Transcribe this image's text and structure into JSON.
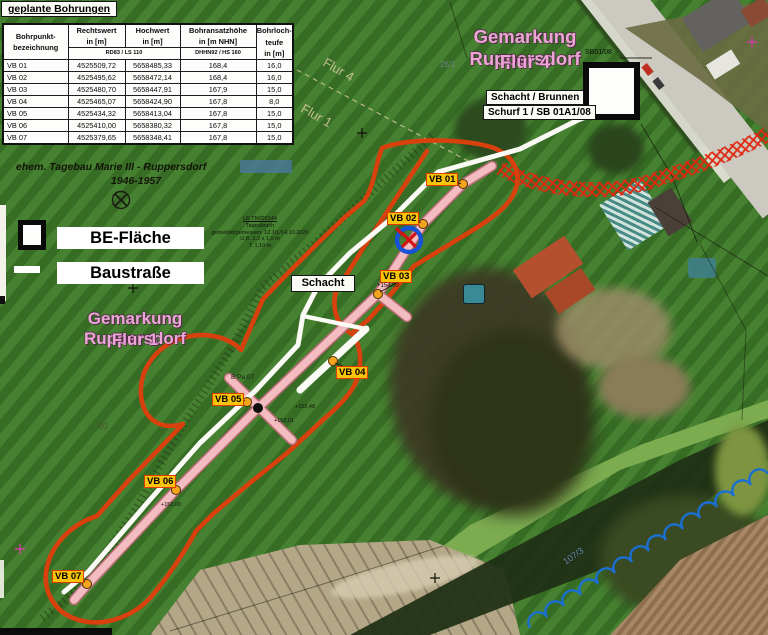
{
  "table": {
    "title": "geplante Bohrungen",
    "col_headers": [
      "Bohrpunkt-\nbezeichnung",
      "Rechtswert\nin [m]",
      "Hochwert\nin [m]",
      "Bohransatzhöhe\nin [m NHN]",
      "Bohrloch-\nteufe\nin [m]"
    ],
    "datum_rd": "RD83 / LS 110",
    "datum_dhhn": "DHHN92 / HS 160",
    "rows": [
      [
        "VB 01",
        "4525509,72",
        "5658485,33",
        "168,4",
        "16,0"
      ],
      [
        "VB 02",
        "4525495,62",
        "5658472,14",
        "168,4",
        "16,0"
      ],
      [
        "VB 03",
        "4525480,70",
        "5658447,91",
        "167,9",
        "15,0"
      ],
      [
        "VB 04",
        "4525465,07",
        "5658424,90",
        "167,8",
        "8,0"
      ],
      [
        "VB 05",
        "4525434,32",
        "5658413,04",
        "167,8",
        "15,0"
      ],
      [
        "VB 06",
        "4525410,00",
        "5658380,32",
        "167,8",
        "15,0"
      ],
      [
        "VB 07",
        "4525379,65",
        "5658348,41",
        "167,8",
        "15,0"
      ]
    ]
  },
  "legend": {
    "be_area": "BE-Fläche",
    "road": "Baustraße"
  },
  "texts": {
    "gemarkung4_line1": "Gemarkung Ruppersdorf",
    "gemarkung4_line2": "Flur 4",
    "gemarkung1_line1": "Gemarkung Ruppersdorf",
    "gemarkung1_line2": "Flur 1",
    "flur4_small": "Flur 4",
    "flur1_small": "Flur 1",
    "tagebau_line1": "ehem. Tagebau Marie III - Ruppersdorf",
    "tagebau_line2": "1946-1957",
    "schacht_brunnen": "Schacht / Brunnen",
    "schurf": "Schurf 1 / SB 01A1/08",
    "sb": "SB01/08",
    "schacht": "Schacht",
    "parcel_26_1": "26/1",
    "parcel_80": "80",
    "parcel_107_3": "107/3",
    "bp_label": "B Pu.07"
  },
  "site_note": {
    "l1": "LB TN026144",
    "l2": "Tagesbruch",
    "l3": "gemeldet/gemessen: 12.10./14.10.2020",
    "l4": "U,B. 1,2 x 1,0 m",
    "l5": "T. 1,10 m"
  },
  "map": {
    "points": [
      {
        "label": "VB 01"
      },
      {
        "label": "VB 02"
      },
      {
        "label": "VB 03",
        "elevation": "+154.00"
      },
      {
        "label": "VB 04"
      },
      {
        "label": "VB 05"
      },
      {
        "label": "VB 06",
        "elevation": "+152,00"
      },
      {
        "label": "VB 07"
      }
    ],
    "elevation_marks": [
      "+152,48",
      "+152,01"
    ]
  },
  "colors": {
    "be_boundary_orange": "#d8400e",
    "baustrasse_white": "#fbfbf6",
    "corridor_pink": "#f2bcc0",
    "marker_yellow": "#f7c40a",
    "marker_border_red": "#e03c00",
    "survey_circle_blue": "#1753d6",
    "water_line_blue": "#1a6fd0",
    "gemarkung_pink": "#eba6d6"
  }
}
